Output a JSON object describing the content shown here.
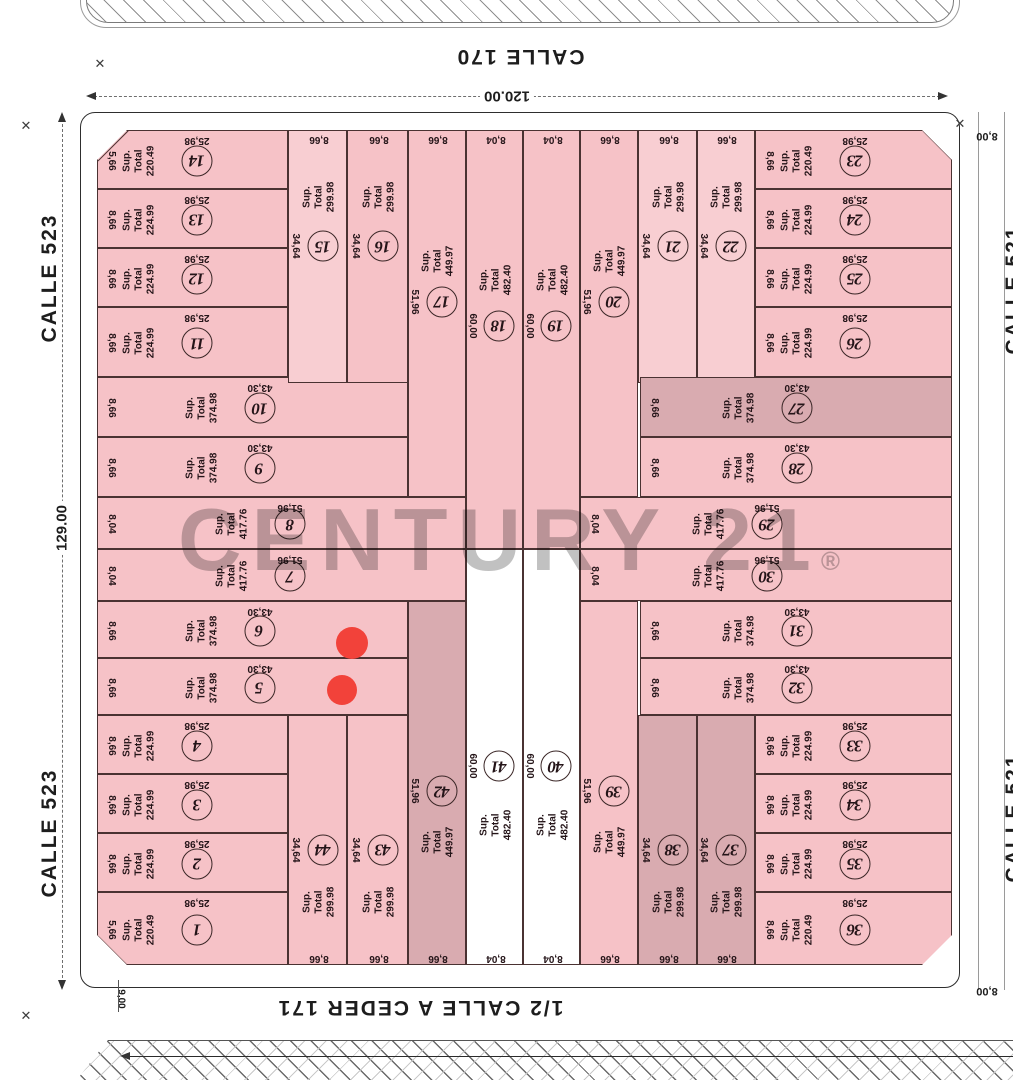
{
  "streets": {
    "top": "CALLE 170",
    "bottom": "1/2 CALLE  A CEDER 171",
    "left": "CALLE 523",
    "right": "CALLE 521"
  },
  "dimensions": {
    "width": "120.00",
    "height": "129.00",
    "sidewalk_bottom": "9,00",
    "right_top": "8,00",
    "right_bottom": "8,00"
  },
  "labels": {
    "sup": "Sup.",
    "total": "Total"
  },
  "watermark": {
    "text": "CENTURY 21",
    "reg": "®"
  },
  "icons": {
    "survey_mark": "✕"
  },
  "colors": {
    "pink": "#f6c2c7",
    "pinkL": "#f8ced2",
    "mauve": "#d9abb0",
    "white": "#ffffff",
    "red_dot": "#f2423a",
    "line": "#4a3232"
  },
  "markers": [
    {
      "x": 352,
      "y": 643,
      "r": 16
    },
    {
      "x": 342,
      "y": 690,
      "r": 15
    }
  ],
  "lots": [
    {
      "n": "1",
      "v": "220.49",
      "side": "5,66",
      "len": "25,98",
      "edge": null,
      "t": "row",
      "f": "pink",
      "r": [
        97,
        892,
        191,
        73
      ],
      "ch": "sw"
    },
    {
      "n": "2",
      "v": "224.99",
      "side": "8,66",
      "len": "25,98",
      "edge": null,
      "t": "row",
      "f": "pink",
      "r": [
        97,
        833,
        191,
        59
      ],
      "ch": null
    },
    {
      "n": "3",
      "v": "224.99",
      "side": "8,66",
      "len": "25,98",
      "edge": null,
      "t": "row",
      "f": "pink",
      "r": [
        97,
        774,
        191,
        59
      ],
      "ch": null
    },
    {
      "n": "4",
      "v": "224.99",
      "side": "8,66",
      "len": "25,98",
      "edge": null,
      "t": "row",
      "f": "pink",
      "r": [
        97,
        715,
        191,
        59
      ],
      "ch": null
    },
    {
      "n": "5",
      "v": "374.98",
      "side": "8,66",
      "len": "43,30",
      "edge": null,
      "t": "row",
      "f": "pink",
      "r": [
        97,
        658,
        311,
        57
      ],
      "ch": null
    },
    {
      "n": "6",
      "v": "374.98",
      "side": "8,66",
      "len": "43,30",
      "edge": null,
      "t": "row",
      "f": "pink",
      "r": [
        97,
        601,
        311,
        57
      ],
      "ch": null
    },
    {
      "n": "7",
      "v": "417.76",
      "side": "8,04",
      "len": "51,96",
      "edge": null,
      "t": "row",
      "f": "pink",
      "r": [
        97,
        549,
        369,
        52
      ],
      "ch": null
    },
    {
      "n": "8",
      "v": "417.76",
      "side": "8,04",
      "len": "51,96",
      "edge": null,
      "t": "row",
      "f": "pink",
      "r": [
        97,
        497,
        369,
        52
      ],
      "ch": null
    },
    {
      "n": "9",
      "v": "374.98",
      "side": "8,66",
      "len": "43,30",
      "edge": null,
      "t": "row",
      "f": "pink",
      "r": [
        97,
        437,
        311,
        60
      ],
      "ch": null
    },
    {
      "n": "10",
      "v": "374.98",
      "side": "8,66",
      "len": "43,30",
      "edge": null,
      "t": "row",
      "f": "pink",
      "r": [
        97,
        377,
        311,
        60
      ],
      "ch": null
    },
    {
      "n": "11",
      "v": "224.99",
      "side": "8,66",
      "len": "25,98",
      "edge": null,
      "t": "row",
      "f": "pink",
      "r": [
        97,
        307,
        191,
        70
      ],
      "ch": null
    },
    {
      "n": "12",
      "v": "224.99",
      "side": "8,66",
      "len": "25,98",
      "edge": null,
      "t": "row",
      "f": "pink",
      "r": [
        97,
        248,
        191,
        59
      ],
      "ch": null
    },
    {
      "n": "13",
      "v": "224.99",
      "side": "8,66",
      "len": "25,98",
      "edge": null,
      "t": "row",
      "f": "pink",
      "r": [
        97,
        189,
        191,
        59
      ],
      "ch": null
    },
    {
      "n": "14",
      "v": "220.49",
      "side": "5,66",
      "len": "25,98",
      "edge": null,
      "t": "row",
      "f": "pink",
      "r": [
        97,
        130,
        191,
        59
      ],
      "ch": "nw"
    },
    {
      "n": "15",
      "v": "299.98",
      "side": null,
      "len": "34,64",
      "edge": "8,66",
      "t": "colTop",
      "f": "pinkL",
      "r": [
        288,
        130,
        59,
        253
      ],
      "ch": null
    },
    {
      "n": "16",
      "v": "299.98",
      "side": null,
      "len": "34,64",
      "edge": "8,66",
      "t": "colTop",
      "f": "pink",
      "r": [
        347,
        130,
        61,
        253
      ],
      "ch": null
    },
    {
      "n": "17",
      "v": "449.97",
      "side": null,
      "len": "51,96",
      "edge": "8,66",
      "t": "colCT",
      "f": "pink",
      "r": [
        408,
        130,
        58,
        367
      ],
      "ch": null
    },
    {
      "n": "18",
      "v": "482.40",
      "side": null,
      "len": "60,00",
      "edge": "8,04",
      "t": "colCT",
      "f": "pink",
      "r": [
        466,
        130,
        57,
        419
      ],
      "ch": null
    },
    {
      "n": "19",
      "v": "482.40",
      "side": null,
      "len": "60,00",
      "edge": "8,04",
      "t": "colCT",
      "f": "pink",
      "r": [
        523,
        130,
        57,
        419
      ],
      "ch": null
    },
    {
      "n": "20",
      "v": "449.97",
      "side": null,
      "len": "51,96",
      "edge": "8,66",
      "t": "colCT",
      "f": "pink",
      "r": [
        580,
        130,
        58,
        367
      ],
      "ch": null
    },
    {
      "n": "21",
      "v": "299.98",
      "side": null,
      "len": "34,64",
      "edge": "8,66",
      "t": "colTop",
      "f": "pinkL",
      "r": [
        638,
        130,
        59,
        253
      ],
      "ch": null
    },
    {
      "n": "22",
      "v": "299.98",
      "side": null,
      "len": "34,64",
      "edge": "8,66",
      "t": "colTop",
      "f": "pinkL",
      "r": [
        697,
        130,
        58,
        253
      ],
      "ch": null
    },
    {
      "n": "23",
      "v": "220.49",
      "side": "8,66",
      "len": "25,98",
      "edge": null,
      "t": "rowR",
      "f": "pink",
      "r": [
        755,
        130,
        197,
        59
      ],
      "ch": "ne"
    },
    {
      "n": "24",
      "v": "224.99",
      "side": "8,66",
      "len": "25,98",
      "edge": null,
      "t": "rowR",
      "f": "pink",
      "r": [
        755,
        189,
        197,
        59
      ],
      "ch": null
    },
    {
      "n": "25",
      "v": "224.99",
      "side": "8,66",
      "len": "25,98",
      "edge": null,
      "t": "rowR",
      "f": "pink",
      "r": [
        755,
        248,
        197,
        59
      ],
      "ch": null
    },
    {
      "n": "26",
      "v": "224.99",
      "side": "8,66",
      "len": "25,98",
      "edge": null,
      "t": "rowR",
      "f": "pink",
      "r": [
        755,
        307,
        197,
        70
      ],
      "ch": null
    },
    {
      "n": "27",
      "v": "374.98",
      "side": "8,66",
      "len": "43,30",
      "edge": null,
      "t": "rowR",
      "f": "mauve",
      "r": [
        640,
        377,
        312,
        60
      ],
      "ch": null
    },
    {
      "n": "28",
      "v": "374.98",
      "side": "8,66",
      "len": "43,30",
      "edge": null,
      "t": "rowR",
      "f": "pink",
      "r": [
        640,
        437,
        312,
        60
      ],
      "ch": null
    },
    {
      "n": "29",
      "v": "417.76",
      "side": "8,04",
      "len": "51,96",
      "edge": null,
      "t": "rowR",
      "f": "pink",
      "r": [
        580,
        497,
        372,
        52
      ],
      "ch": null
    },
    {
      "n": "30",
      "v": "417.76",
      "side": "8,04",
      "len": "51,96",
      "edge": null,
      "t": "rowR",
      "f": "pink",
      "r": [
        580,
        549,
        372,
        52
      ],
      "ch": null
    },
    {
      "n": "31",
      "v": "374.98",
      "side": "8,66",
      "len": "43,30",
      "edge": null,
      "t": "rowR",
      "f": "pink",
      "r": [
        640,
        601,
        312,
        57
      ],
      "ch": null
    },
    {
      "n": "32",
      "v": "374.98",
      "side": "8,66",
      "len": "43,30",
      "edge": null,
      "t": "rowR",
      "f": "pink",
      "r": [
        640,
        658,
        312,
        57
      ],
      "ch": null
    },
    {
      "n": "33",
      "v": "224.99",
      "side": "8,66",
      "len": "25,98",
      "edge": null,
      "t": "rowR",
      "f": "pink",
      "r": [
        755,
        715,
        197,
        59
      ],
      "ch": null
    },
    {
      "n": "34",
      "v": "224.99",
      "side": "8,66",
      "len": "25,98",
      "edge": null,
      "t": "rowR",
      "f": "pink",
      "r": [
        755,
        774,
        197,
        59
      ],
      "ch": null
    },
    {
      "n": "35",
      "v": "224.99",
      "side": "8,66",
      "len": "25,98",
      "edge": null,
      "t": "rowR",
      "f": "pink",
      "r": [
        755,
        833,
        197,
        59
      ],
      "ch": null
    },
    {
      "n": "36",
      "v": "220.49",
      "side": "8,66",
      "len": "25,98",
      "edge": null,
      "t": "rowR",
      "f": "pink",
      "r": [
        755,
        892,
        197,
        73
      ],
      "ch": "se"
    },
    {
      "n": "37",
      "v": "299.98",
      "side": null,
      "len": "34,64",
      "edge": "8,66",
      "t": "colBot",
      "f": "mauve",
      "r": [
        697,
        715,
        58,
        250
      ],
      "ch": null
    },
    {
      "n": "38",
      "v": "299.98",
      "side": null,
      "len": "34,64",
      "edge": "8,66",
      "t": "colBot",
      "f": "mauve",
      "r": [
        638,
        715,
        59,
        250
      ],
      "ch": null
    },
    {
      "n": "39",
      "v": "449.97",
      "side": null,
      "len": "51,96",
      "edge": "8,66",
      "t": "colCB",
      "f": "pink",
      "r": [
        580,
        601,
        58,
        364
      ],
      "ch": null
    },
    {
      "n": "40",
      "v": "482.40",
      "side": null,
      "len": "60,00",
      "edge": "8,04",
      "t": "colCB",
      "f": "white",
      "r": [
        523,
        549,
        57,
        416
      ],
      "ch": null
    },
    {
      "n": "41",
      "v": "482.40",
      "side": null,
      "len": "60,00",
      "edge": "8,04",
      "t": "colCB",
      "f": "white",
      "r": [
        466,
        549,
        57,
        416
      ],
      "ch": null
    },
    {
      "n": "42",
      "v": "449.97",
      "side": null,
      "len": "51,96",
      "edge": "8,66",
      "t": "colCB",
      "f": "mauve",
      "r": [
        408,
        601,
        58,
        364
      ],
      "ch": null
    },
    {
      "n": "43",
      "v": "299.98",
      "side": null,
      "len": "34,64",
      "edge": "8,66",
      "t": "colBot",
      "f": "pink",
      "r": [
        347,
        715,
        61,
        250
      ],
      "ch": null
    },
    {
      "n": "44",
      "v": "299.98",
      "side": null,
      "len": "34,64",
      "edge": "8,66",
      "t": "colBot",
      "f": "pink",
      "r": [
        288,
        715,
        59,
        250
      ],
      "ch": null
    }
  ]
}
